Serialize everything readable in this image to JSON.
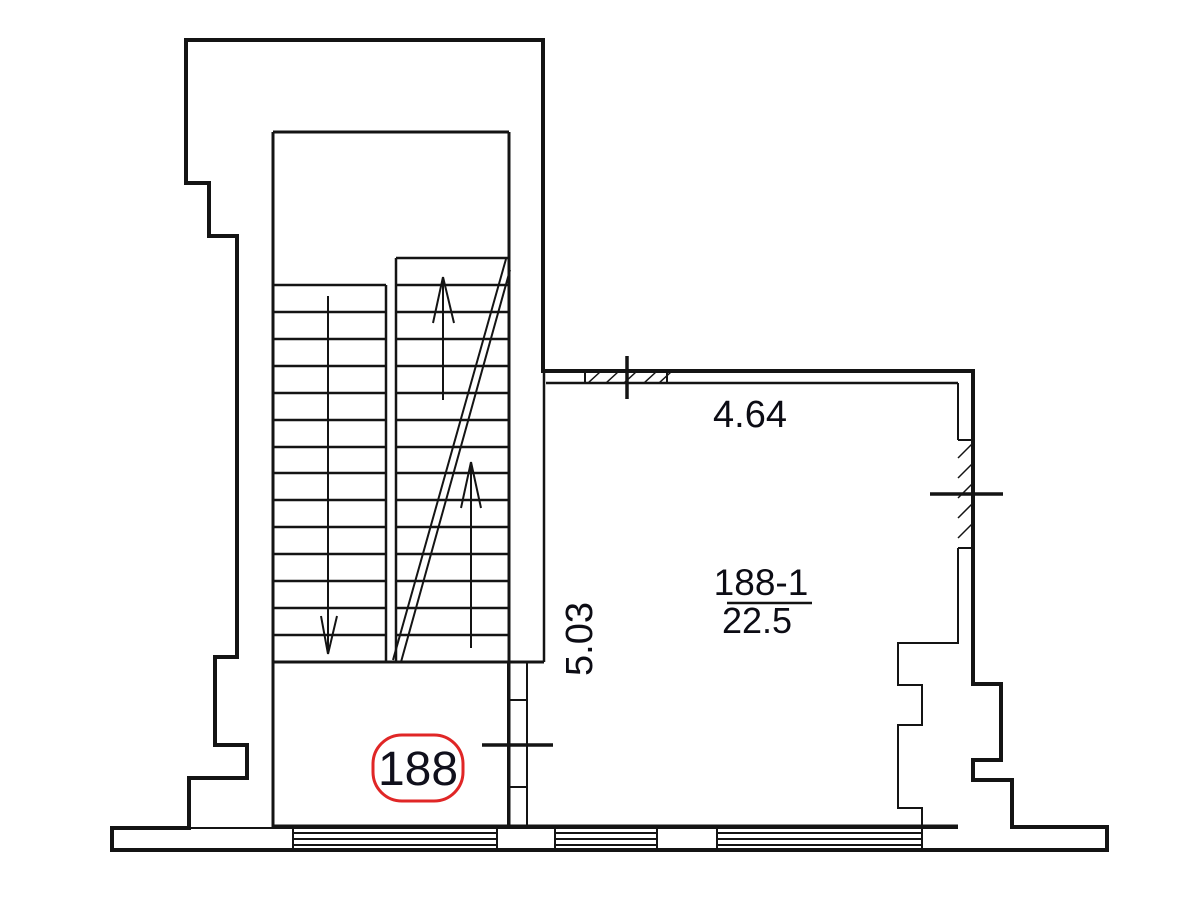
{
  "plan": {
    "unit_badge": "188",
    "room": {
      "number": "188-1",
      "area": "22.5"
    },
    "dimensions": {
      "width": "4.64",
      "height": "5.03"
    }
  },
  "colors": {
    "line": "#141414",
    "text": "#0c0c14",
    "badge_outline": "#e02626"
  }
}
